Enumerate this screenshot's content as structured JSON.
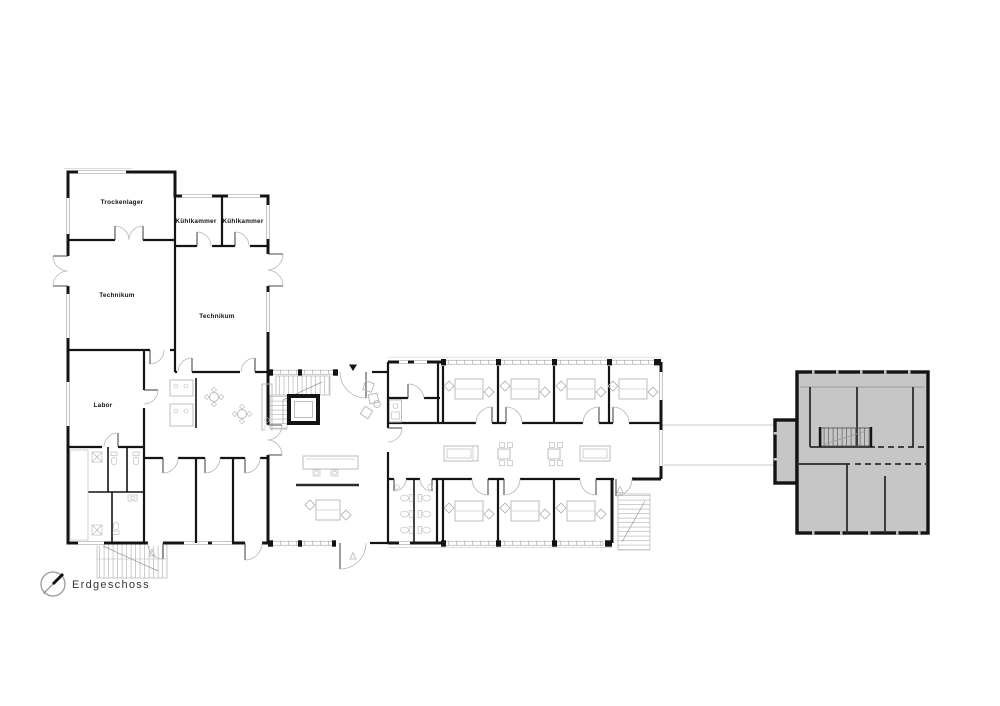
{
  "legend": {
    "floor_label": "Erdgeschoss",
    "north_arrow_icon": "north-arrow"
  },
  "rooms": {
    "trockenlager": "Trockenlager",
    "kuehlkammer_left": "Kühlkammer",
    "kuehlkammer_right": "Kühlkammer",
    "technikum_left": "Technikum",
    "technikum_right": "Technikum",
    "labor": "Labor"
  },
  "colors": {
    "wall": "#141414",
    "furniture_line": "#b5b5b5",
    "existing_building_fill": "#c6c6c6",
    "background": "#ffffff"
  }
}
